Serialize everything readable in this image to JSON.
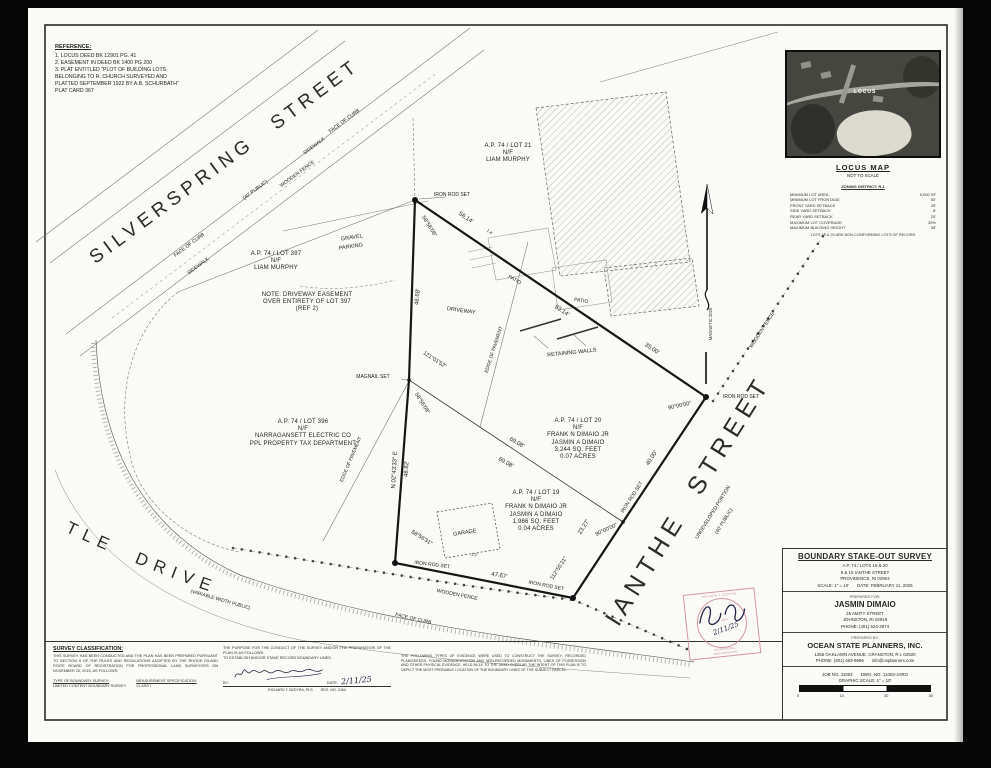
{
  "reference": {
    "title": "REFERENCE:",
    "lines": [
      "1.  LOCUS DEED BK 12901 PG. 41",
      "2.  EASEMENT IN DEED BK 1400 PG 200",
      "3.  PLAT ENTITLED \"PLOT OF BUILDING LOTS",
      "BELONGING TO R. CHURCH  SURVEYED AND",
      "PLATTED SEPTEMBER 1922 BY A.B. SCHURBATH\"",
      "PLAT CARD 367"
    ]
  },
  "locus": {
    "title": "LOCUS MAP",
    "subtitle": "NOT TO SCALE",
    "marker": "LOCUS",
    "zoning_title": "ZONING DISTRICT: R-1",
    "rows": [
      {
        "k": "MINIMUM LOT AREA",
        "v": "5,000 SF"
      },
      {
        "k": "MINIMUM LOT FRONTAGE",
        "v": "50'"
      },
      {
        "k": "FRONT YARD SETBACK",
        "v": "25'"
      },
      {
        "k": "SIDE YARD SETBACK",
        "v": "8'"
      },
      {
        "k": "REAR YARD SETBACK",
        "v": "20'"
      },
      {
        "k": "MAXIMUM LOT COVERAGE",
        "v": "35%"
      },
      {
        "k": "MAXIMUM BUILDING HEIGHT",
        "v": "35'"
      }
    ],
    "note": "LOTS 19 & 20 ARE NON-CONFORMING LOTS OF RECORD"
  },
  "streets": {
    "silverspring": "SILVERSPRING STREET",
    "silverspring_sub": "(40' PUBLIC)",
    "ianthe": "IANTHE STREET",
    "ianthe_sub1": "UNDEVELOPED PORTION",
    "ianthe_sub2": "(40' PUBLIC)",
    "royal": "ROYAL LITTLE DRIVE",
    "royal_sub": "(VARIABLE WIDTH PUBLIC)"
  },
  "parcels": {
    "lot21": {
      "lines": [
        "A.P. 74 / LOT 21",
        "N/F",
        "LIAM MURPHY"
      ]
    },
    "lot397": {
      "lines": [
        "A.P. 74 / LOT 397",
        "N/F",
        "LIAM MURPHY"
      ]
    },
    "note397": {
      "lines": [
        "NOTE: DRIVEWAY EASEMENT",
        "OVER ENTIRETY OF LOT 397",
        "(REF 2)"
      ]
    },
    "lot396": {
      "lines": [
        "A.P. 74 / LOT 396",
        "N/F",
        "NARRAGANSETT ELECTRIC CO",
        "PPL PROPERTY TAX DEPARTMENT"
      ]
    },
    "lot20": {
      "lines": [
        "A.P. 74 / LOT 20",
        "N/F",
        "FRANK N DIMAIO JR",
        "JASMIN A DIMAIO",
        "3,244 SQ. FEET",
        "0.07 ACRES"
      ]
    },
    "lot19": {
      "lines": [
        "A.P. 74 / LOT 19",
        "N/F",
        "FRANK N DIMAIO JR",
        "JASMIN A DIMAIO",
        "1,966 SQ. FEET",
        "0.04 ACRES"
      ]
    }
  },
  "site": {
    "face_of_curb": "FACE OF CURB",
    "sidewalk": "SIDEWALK",
    "wooden_fence": "WOODEN FENCE",
    "edge_of_pavement": "EDGE OF PAVEMENT",
    "iron_rod_set": "IRON ROD SET",
    "magnail_set": "MAGNAIL SET",
    "gravel_1": "GRAVEL",
    "gravel_2": "PARKING",
    "driveway": "DRIVEWAY",
    "patio": "PATIO",
    "retaining": "RETAINING WALLS",
    "garage": "GARAGE",
    "magnetic": "MAGNETIC 2025"
  },
  "dims": {
    "d5614": "56.14'",
    "d9314": "93.14'",
    "d3500": "35.00'",
    "d4000": "40.00'",
    "d2327": "23.27'",
    "d4767": "47.67'",
    "d4668": "46.68'",
    "d4882": "48.82'",
    "d6908": "69.08'",
    "brgN": "N 02°43'33\" E",
    "a121": "121°01'52\"",
    "a5856": "58°56'08\"",
    "a585631": "58°56'31\"",
    "a1125521": "112°55'21\"",
    "a90": "90°00'00\"",
    "off14": "1.4'",
    "off13": "1.3'"
  },
  "titleblock": {
    "title": "BOUNDARY STAKE-OUT SURVEY",
    "l1": "A.P. 74 / LOTS 19 & 20",
    "l2": "9 & 15 IANTHE STREET",
    "l3": "PROVIDENCE, RI 02904",
    "l4a": "SCALE: 1\" = 10'",
    "l4b": "DATE: FEBRUARY 11, 2025",
    "pf": "PREPARED FOR:",
    "client": "JASMIN DIMAIO",
    "ca1": "25 AMITY STREET",
    "ca2": "JOHNSTON, RI 02919",
    "cph": "PHONE: (401) 524-2974",
    "pb": "PREPARED BY:",
    "firm": "OCEAN STATE PLANNERS, INC.",
    "fa1": "1255 OAKLAWN AVENUE, CRANSTON, R.I. 02920",
    "fph1": "PHONE: (401) 463-9696",
    "fph2": "info@osplanners.com",
    "job1": "JOB NO. 11002",
    "job2": "DWG. NO. 11002-JARO",
    "gs": "GRAPHIC SCALE: 1\" = 10'"
  },
  "scalebar": {
    "t0": "0",
    "t1": "10",
    "t2": "20",
    "t3": "30"
  },
  "cert": {
    "class_title": "SURVEY CLASSIFICATION:",
    "class_para": "THIS SURVEY HAS BEEN CONDUCTED AND THE PLAN HAS BEEN PREPARED PURSUANT TO SECTION 9 OF THE RULES AND REGULATIONS ADOPTED BY THE RHODE ISLAND STATE BOARD OF REGISTRATION FOR PROFESSIONAL LAND SURVEYORS ON NOVEMBER 25, 2015, AS FOLLOWS:",
    "type_label": "TYPE OF BOUNDARY SURVEY:",
    "type_value": "LIMITED CONTENT BOUNDARY SURVEY",
    "meas_label": "MEASUREMENT SPECIFICATION:",
    "meas_value": "CLASS I",
    "purpose_para": "THE PURPOSE FOR THE CONDUCT OF THE SURVEY AND/OR THE PREPARATION OF THE PLAN IS AS FOLLOWS:",
    "purpose_value": "TO ESTABLISH AND/OR STAKE RECORD BOUNDARY LINES.",
    "by_label": "BY:",
    "date_label": "DATE:",
    "date_value": "2/11/25",
    "sur1": "RICHARD T. BZDYRA, PLS",
    "sur2": "REG. NO. 2454"
  },
  "notes": {
    "para": "THE FOLLOWING TYPES OF EVIDENCE WERE USED TO CONSTRUCT THE SURVEY: RECORDED PLANS/DEEDS, FOUND MONUMENTATION AND NON-RECORDED MONUMENTS, LINES OF POSSESSION AND OTHER PHYSICAL EVIDENCE. HELD 56.14' TO THE DEED OVERLAP. THE INTENT OF THIS PLAN IS TO DEPICT THE MOST PROBABLE LOCATION OF THE BOUNDARY LINES OF THE SUBJECT PARCEL."
  },
  "stamp": {
    "name": "RICHARD T. BZDYRA",
    "no": "No. 2454",
    "title1": "PROFESSIONAL",
    "title2": "LAND SURVEYOR",
    "date": "2/11/25"
  }
}
